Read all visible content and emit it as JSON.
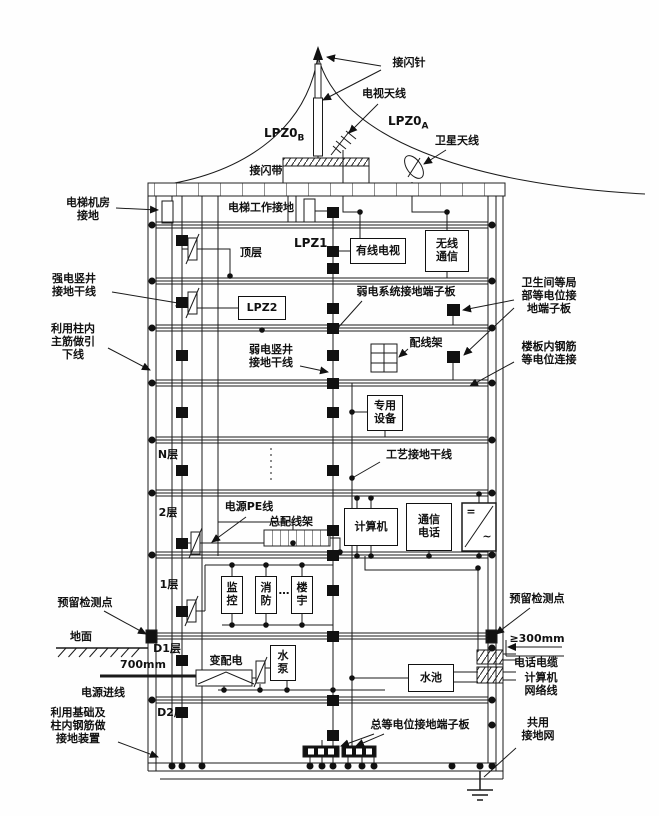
{
  "zones": {
    "lpz0a": "LPZ0",
    "lpz0a_sub": "A",
    "lpz0b": "LPZ0",
    "lpz0b_sub": "B",
    "lpz1": "LPZ1",
    "lpz2": "LPZ2"
  },
  "roof": {
    "air_terminal": "接闪针",
    "tv_antenna": "电视天线",
    "satellite_antenna": "卫星天线",
    "air_termination_belt": "接闪带"
  },
  "left": {
    "elevator_room_ground": "电梯机房\n接地",
    "strong_shaft_riser": "强电竖井\n接地干线",
    "column_rebar_down_conductor": "利用柱内\n主筋做引\n下线",
    "reserved_test_point": "预留检测点",
    "ground_surface": "地面",
    "depth_700": "700mm",
    "power_incoming": "电源进线",
    "foundation_rebar_ground": "利用基础及\n柱内钢筋做\n接地装置"
  },
  "right": {
    "bathroom_terminal": "卫生间等局\n部等电位接\n地端子板",
    "slab_rebar_bond": "楼板内钢筋\n等电位连接",
    "reserved_test_point": "预留检测点",
    "min_300": "≥300mm",
    "phone_cable": "电话电缆",
    "computer_network": "计算机\n网络线",
    "common_ground_grid": "共用\n接地网"
  },
  "floors": {
    "top": "顶层",
    "n": "N层",
    "f2": "2层",
    "f1": "1层",
    "d1": "D1层",
    "d2": "D2层"
  },
  "interior": {
    "elevator_working_ground": "电梯工作接地",
    "cable_tv": "有线电视",
    "wireless_comm": "无线\n通信",
    "weak_system_terminal": "弱电系统接地端子板",
    "wiring_frame": "配线架",
    "weak_shaft_riser": "弱电竖井\n接地干线",
    "dedicated_equipment": "专用\n设备",
    "process_ground_riser": "工艺接地干线",
    "power_pe": "电源PE线",
    "main_wiring_frame": "总配线架",
    "computer": "计算机",
    "comm_phone": "通信\n电话",
    "converter_dc": "=",
    "converter_ac": "~",
    "monitoring": "监\n控",
    "fire": "消\n防",
    "building_auto": "楼\n宇",
    "ellipsis": "…",
    "transformer": "变配电",
    "water_pump": "水\n泵",
    "water_pool": "水池",
    "main_equipotential_terminal": "总等电位接地端子板"
  }
}
